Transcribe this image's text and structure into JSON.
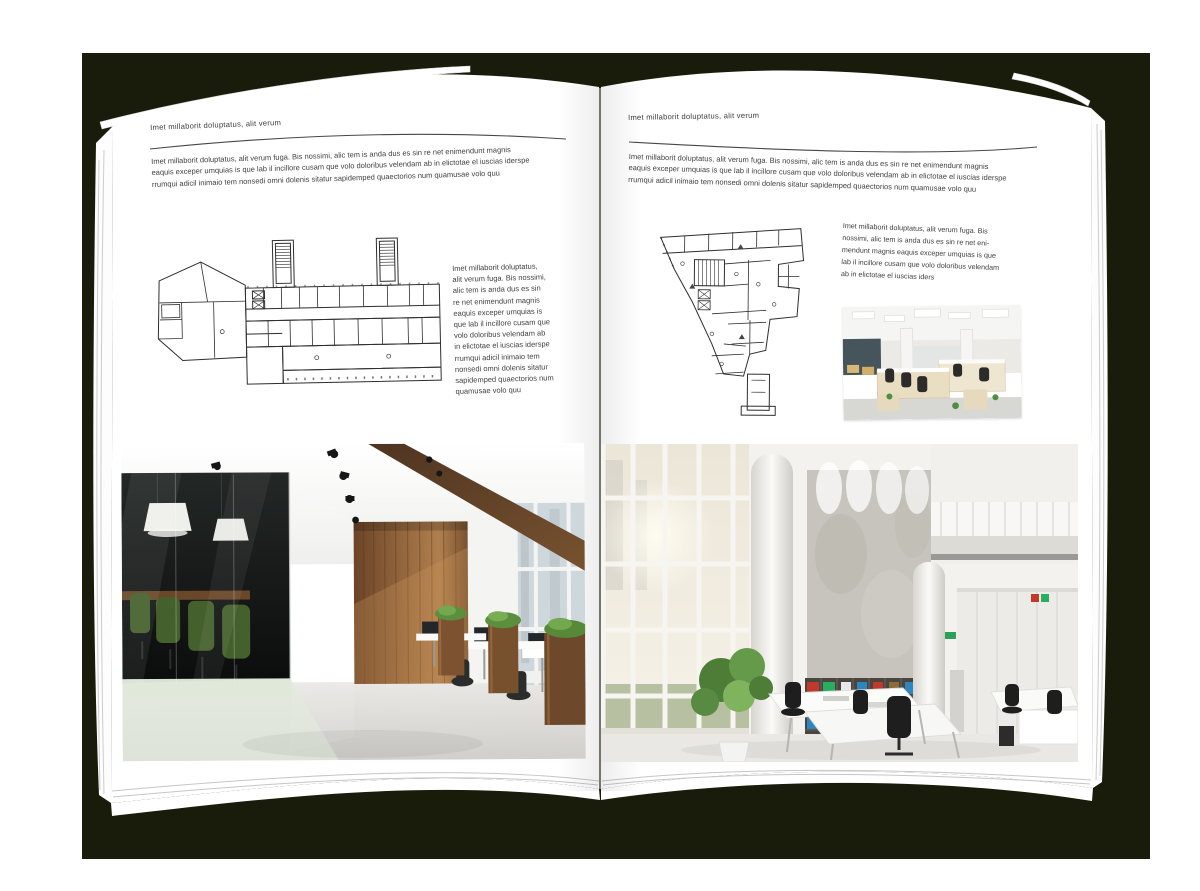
{
  "artboard": {
    "width": 1200,
    "height": 891,
    "backdrop_color": "#191c0a",
    "page_color": "#ffffff",
    "text_color": "#3f3f3f",
    "rule_color": "#474747",
    "plan_line_color": "#2e2e2e"
  },
  "left_page": {
    "header": "Imet millaborit doluptatus, alit verum",
    "intro": "Imet millaborit doluptatus, alit verum fuga. Bis nossimi, alic tem is anda dus es sin re net enimendunt magnis\neaquis exceper umquias is que lab il incillore cusam que volo doloribus velendam ab in elictotae el iuscias iderspe\nrrumqui adicil inimaio tem nonsedi omni dolenis sitatur sapidemped quaectorios num quamusae volo quu",
    "caption": "Imet millaborit doluptatus,\nalit verum fuga. Bis nossimi,\nalic tem is anda dus es sin\nre net enimendunt magnis\neaquis exceper umquias is\nque lab il incillore cusam que\nvolo doloribus velendam ab\nin elictotae el iuscias iderspe\nrrumqui adicil inimaio tem\nnonsedi omni dolenis sitatur\nsapidemped quaectorios num\nquamusae volo quu",
    "floor_plan": "wide-office-building-floor-plan",
    "photo": "office-interior-wood-wall-glass-meeting-room"
  },
  "right_page": {
    "header": "Imet millaborit doluptatus, alit verum",
    "intro": "Imet millaborit doluptatus, alit verum fuga. Bis nossimi, alic tem is anda dus es sin re net enimendunt magnis\neaquis exceper umquias is que lab il incillore cusam que volo doloribus velendam ab in elictotae el iuscias iderspe\nrrumqui adicil inimaio tem nonsedi omni dolenis sitatur sapidemped quaectorios num quamusae volo quu",
    "caption": "Imet millaborit doluptatus, alit verum fuga. Bis\nnossimi, alic tem is anda dus es sin re net eni-\nmendunt magnis eaquis exceper umquias is que\nlab il incillore cusam que volo doloribus velendam\nab in elictotae el iuscias iders",
    "floor_plan": "tower-office-building-floor-plan",
    "photo_small": "open-plan-office-workstations",
    "photo_large": "white-double-height-office-atrium"
  },
  "photo_palette": {
    "wood_wall": "#8a5c36",
    "wood_beam": "#5d4027",
    "chair_green": "#44602c",
    "plant_green": "#5c8f3d",
    "concrete_wall": "#c7c4bd",
    "binder_red": "#c0392b",
    "binder_green": "#27ae60",
    "binder_blue": "#2e86c1"
  }
}
